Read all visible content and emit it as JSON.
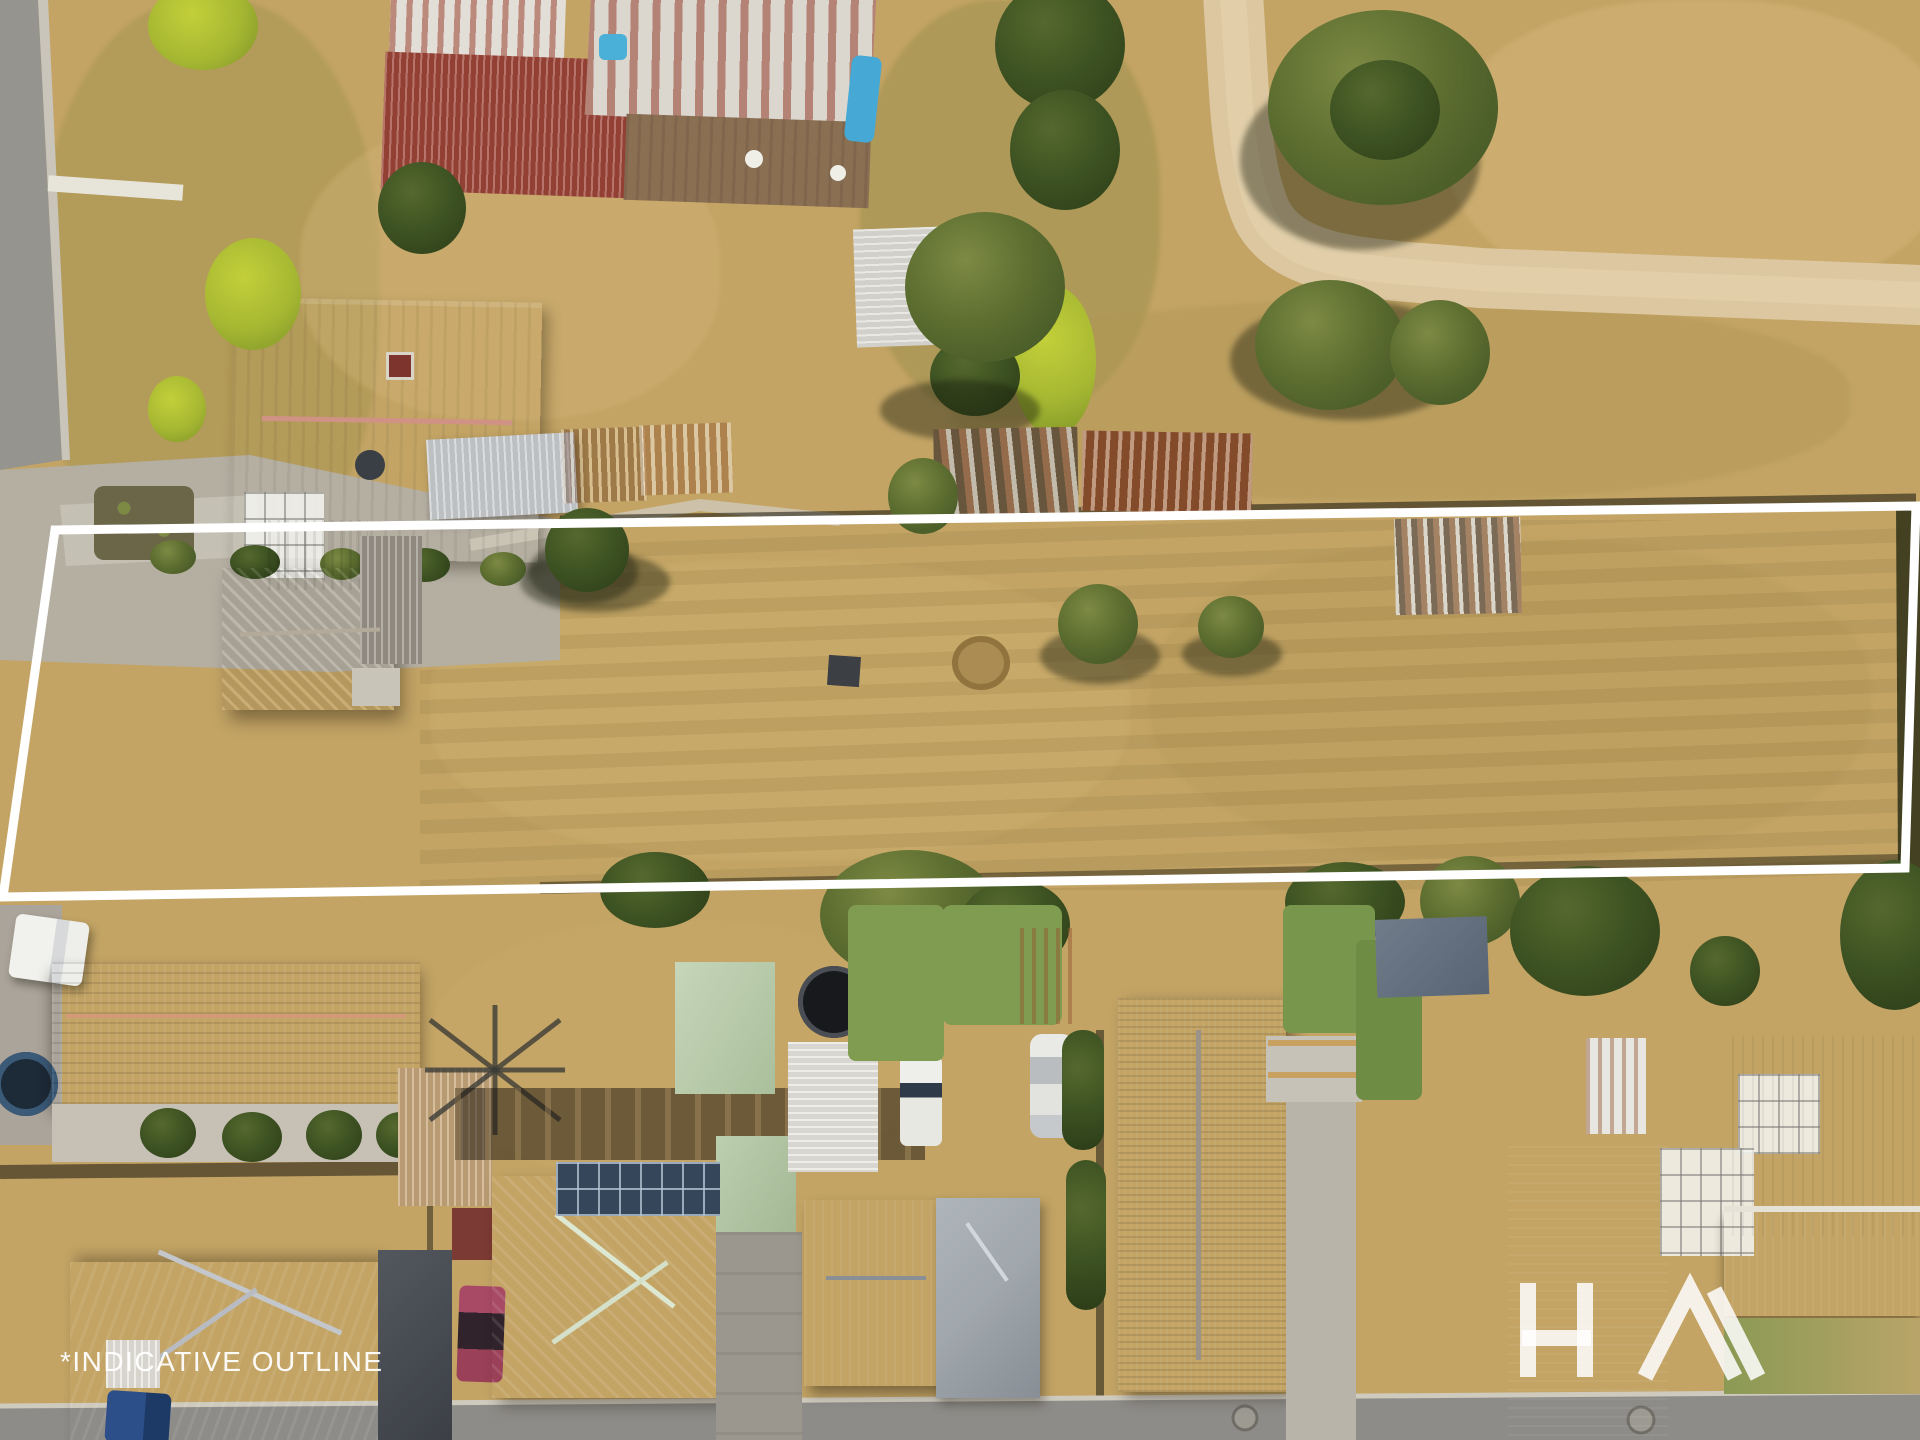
{
  "overlay": {
    "disclaimer": "*INDICATIVE OUTLINE",
    "logo_text": "HA\\",
    "logo_name": "agency-watermark-logo",
    "outline_color": "#ffffff",
    "watermark_color": "rgba(255,255,255,0.85)"
  },
  "scene": {
    "type": "aerial-drone-photo",
    "palette": {
      "dry_grass": "#c3a465",
      "paddock": "#bda061",
      "green_lawn": "#7f9c50",
      "road_grey": "#96948e",
      "concrete": "#b8b3a8",
      "dirt_path_sand": "#dcc7a0",
      "red_roof": "#9e4538",
      "salmon_roof": "#b25a50",
      "terracotta_tiles": "#ad6a4e",
      "sage_roof": "#b7c9a9",
      "charcoal_roof": "#4b5056",
      "weathered_shingle": "#857d70",
      "rust": "#a05f38",
      "dark_red_roof": "#8c3a33",
      "tree_olive": "#5d6e30"
    }
  }
}
